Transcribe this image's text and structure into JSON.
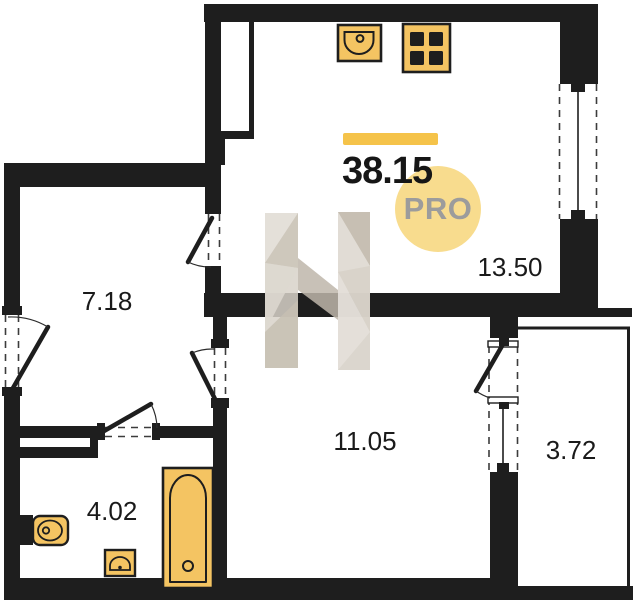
{
  "floor_plan": {
    "total_area": "38.15",
    "badge_label": "PRO",
    "rooms": [
      {
        "id": "hallway",
        "area": "7.18"
      },
      {
        "id": "kitchen_living_room",
        "area": "13.50"
      },
      {
        "id": "room",
        "area": "11.05"
      },
      {
        "id": "bathroom",
        "area": "4.02"
      },
      {
        "id": "balcony",
        "area": "3.72"
      }
    ],
    "fixtures": [
      {
        "icon": "kitchen-sink-icon",
        "room": "kitchen_living_room"
      },
      {
        "icon": "stove-icon",
        "room": "kitchen_living_room"
      },
      {
        "icon": "bathtub-icon",
        "room": "bathroom"
      },
      {
        "icon": "toilet-icon",
        "room": "bathroom"
      },
      {
        "icon": "washbasin-icon",
        "room": "bathroom"
      }
    ],
    "watermark_icon": "h-logo-watermark",
    "colors": {
      "wall": "#1E1E1E",
      "fixture_fill": "#F4C462",
      "accent_bar": "#F5C34A",
      "badge_bg": "#F8DC8E",
      "badge_text": "#9C9C9C",
      "watermark": "#D6D0C7"
    }
  }
}
